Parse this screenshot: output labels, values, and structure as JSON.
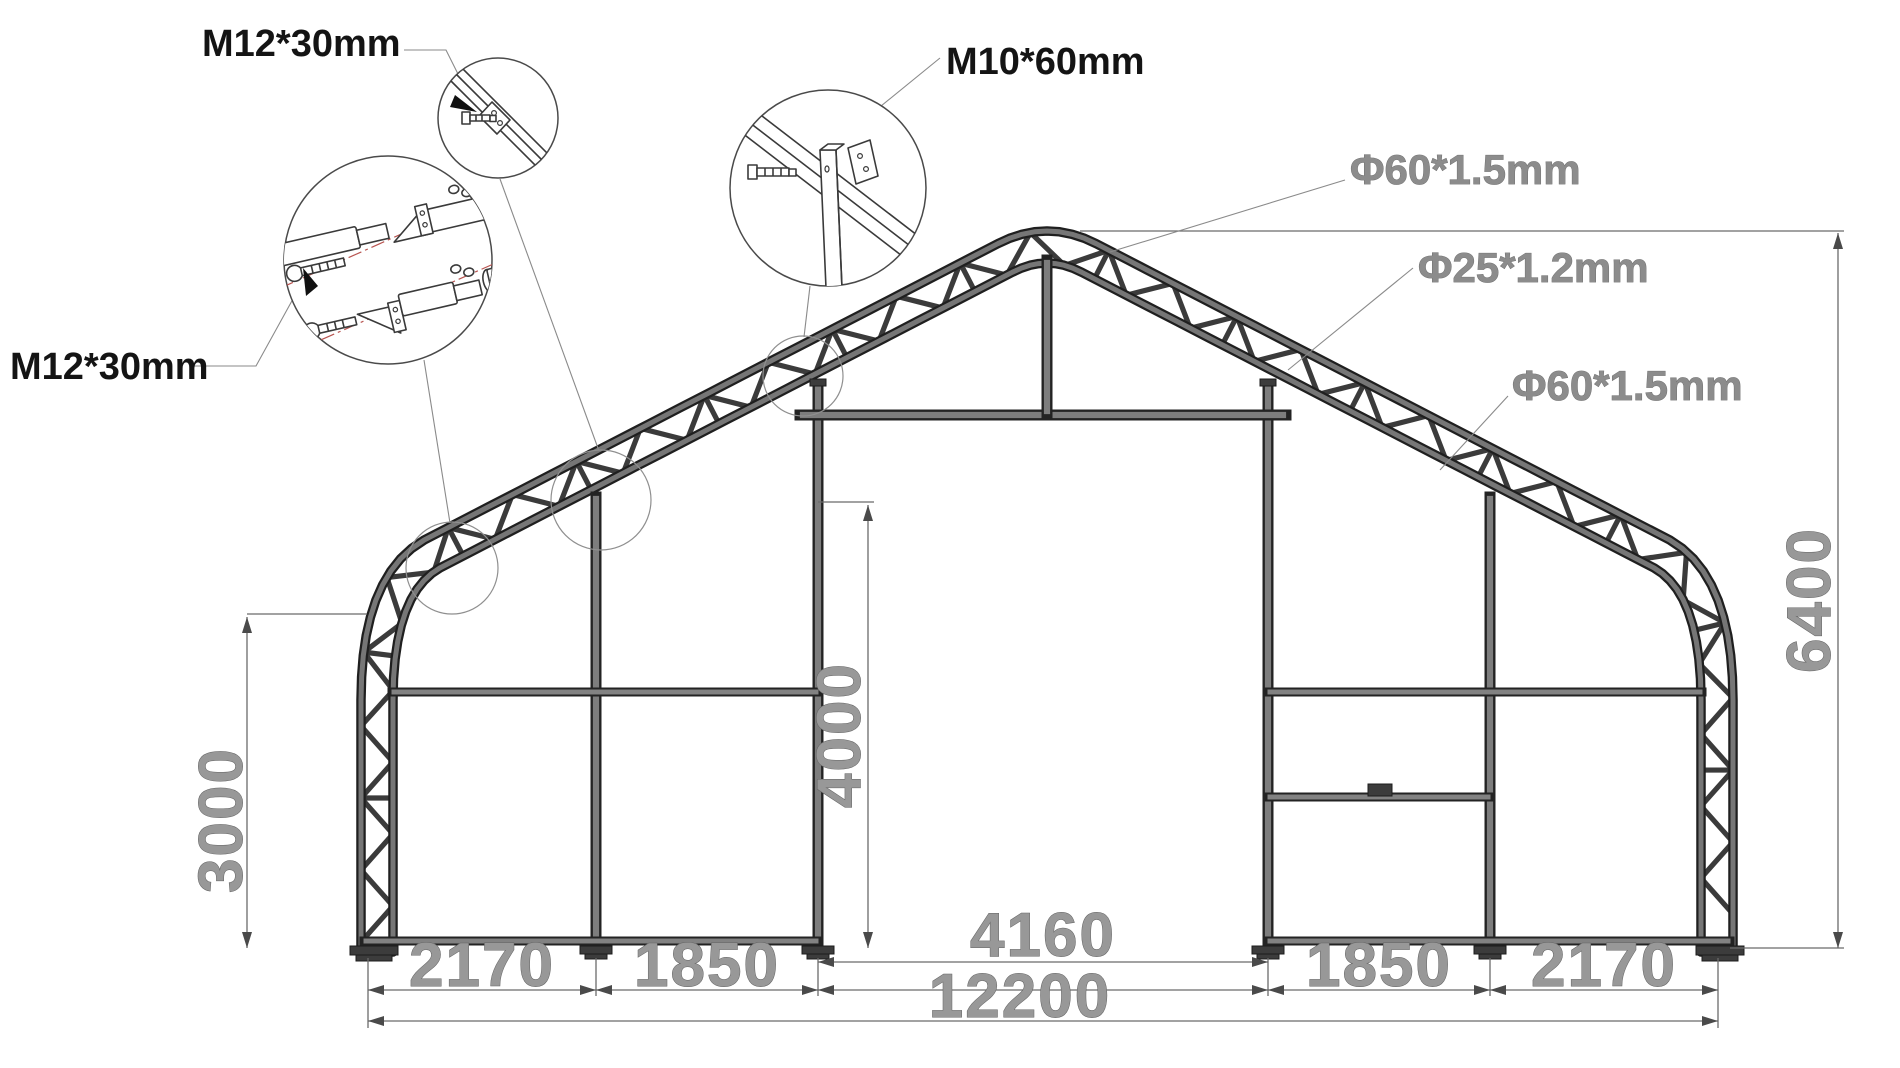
{
  "callouts": {
    "bolt_splice_top": "M12*30mm",
    "bolt_splice_left": "M12*30mm",
    "bolt_brace": "M10*60mm",
    "tube_roof": "Φ60*1.5mm",
    "tube_web": "Φ25*1.2mm",
    "tube_side": "Φ60*1.5mm"
  },
  "dimensions": {
    "bay_left_outer": "2170",
    "bay_left_inner": "1850",
    "door_width": "4160",
    "total_span": "12200",
    "bay_right_inner": "1850",
    "bay_right_outer": "2170",
    "eave_height": "3000",
    "door_height": "4000",
    "ridge_height": "6400"
  },
  "colors": {
    "background": "#ffffff",
    "frame_fill": "#767676",
    "frame_outline": "#1f1f1f",
    "web_stroke": "#3b3b3b",
    "dim_text": "#989898",
    "dim_line": "#6b6b6b",
    "callout_text": "#141414",
    "centerline_red": "#b85450"
  }
}
